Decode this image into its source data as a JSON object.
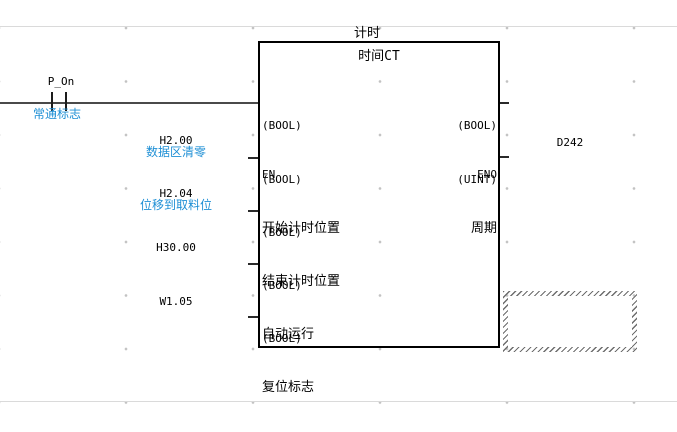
{
  "rung": {
    "contact": {
      "operand": "P_On",
      "comment": "常通标志"
    },
    "fb": {
      "instance_name": "计时",
      "definition_name": "时间CT",
      "inputs": [
        {
          "type": "(BOOL)",
          "name": "EN",
          "operand": "",
          "comment": ""
        },
        {
          "type": "(BOOL)",
          "name": "开始计时位置",
          "operand": "H2.00",
          "comment": "数据区清零"
        },
        {
          "type": "(BOOL)",
          "name": "结束计时位置",
          "operand": "H2.04",
          "comment": "位移到取料位"
        },
        {
          "type": "(BOOL)",
          "name": "自动运行",
          "operand": "H30.00",
          "comment": ""
        },
        {
          "type": "(BOOL)",
          "name": "复位标志",
          "operand": "W1.05",
          "comment": ""
        }
      ],
      "outputs": [
        {
          "type": "(BOOL)",
          "name": "ENO",
          "operand": ""
        },
        {
          "type": "(UINT)",
          "name": "周期",
          "operand": "D242"
        }
      ]
    },
    "colors": {
      "comment_blue": "#1E8FD5",
      "wire_gray": "#4A4A4A",
      "block_border": "#000000",
      "grid_dot": "#C2C2C2",
      "separator": "#DADADA"
    }
  }
}
